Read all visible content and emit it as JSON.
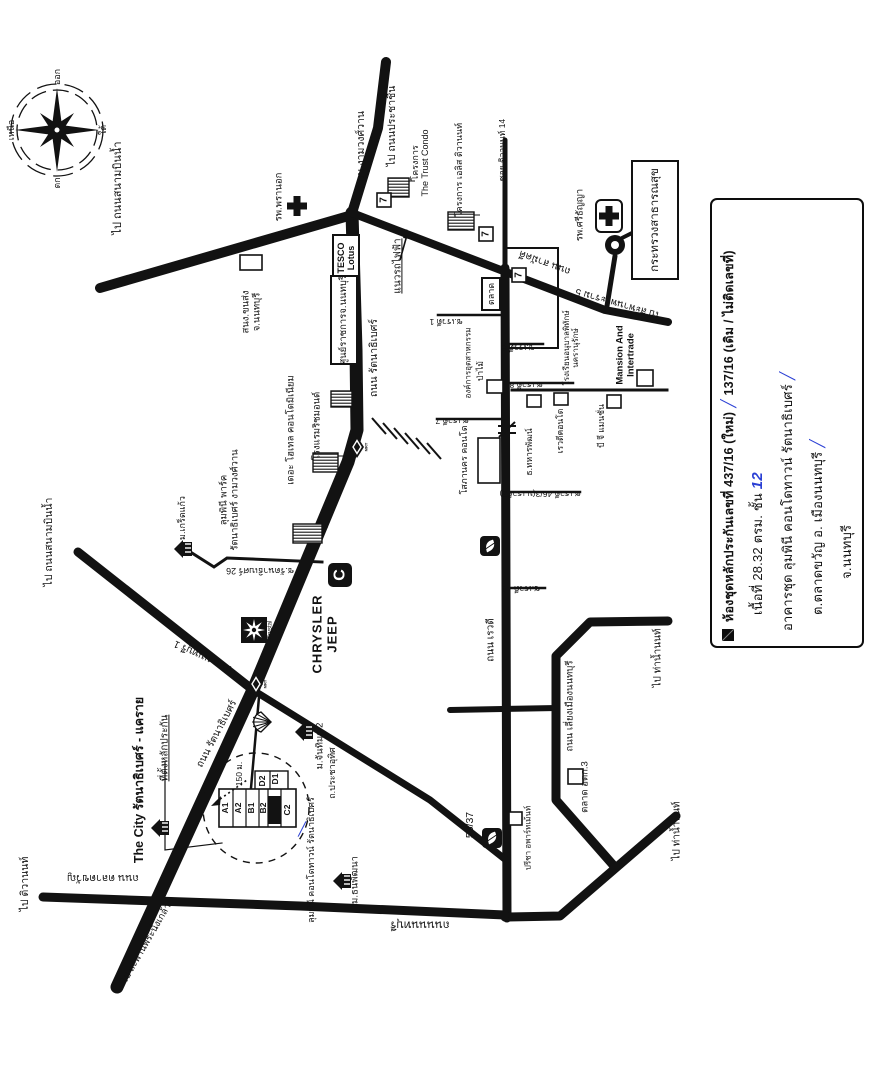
{
  "colors": {
    "ink": "#121212",
    "paper": "#ffffff",
    "blue": "#2a3fd4"
  },
  "compass": {
    "north": "เหนือ",
    "east": "ออก",
    "south": "ใต้",
    "west": "ตก",
    "cx": 57,
    "cy": 130
  },
  "legend": {
    "marker": "legend-black-square",
    "line1a": "ห้องชุดหลักประกันเลขที่ 437/16 (ใหม่)",
    "line1b": "137/16 (เดิม / ไม่ติดเลขที่)",
    "line2a": "เนื้อที่ 28.32 ตรม. ชั้น",
    "line2b": "12",
    "line3": "อาคารชุด ลุมพินี คอนโดทาวน์ รัตนาธิเบศร์",
    "line4": "ต.ตลาดขวัญ อ. เมืองนนทบุรี",
    "line5": "จ.นนทบุรี",
    "tick": "╱"
  },
  "map": {
    "labels": [
      {
        "t": "ไป ถนนสนามบินน้ำ",
        "x": 118,
        "y": 188,
        "r": -90,
        "s": 11
      },
      {
        "t": "รพ.พรานอก",
        "x": 280,
        "y": 197,
        "r": -90,
        "s": 9.5
      },
      {
        "t": "ถนน งามวงศ์วาน",
        "x": 362,
        "y": 150,
        "r": -90,
        "s": 10.5
      },
      {
        "t": "ไป ถนนประชาชื่น",
        "x": 393,
        "y": 126,
        "r": -90,
        "s": 10.5
      },
      {
        "t": "โครงการ\nThe Trust Condo",
        "x": 420,
        "y": 163,
        "r": -90,
        "s": 9
      },
      {
        "t": "โครงการ เอลิส ติวานนท์",
        "x": 459,
        "y": 170,
        "r": -90,
        "s": 9
      },
      {
        "t": "ซอย ติวานนท์ 14",
        "x": 503,
        "y": 150,
        "r": -90,
        "s": 8.5
      },
      {
        "t": "รพ.ศรีธัญญา",
        "x": 581,
        "y": 215,
        "r": -90,
        "s": 9.5
      },
      {
        "t": "กระทรวงสาธารณสุข",
        "x": 655,
        "y": 220,
        "r": -90,
        "s": 11.5,
        "box": [
          116,
          44
        ]
      },
      {
        "t": "ไป สะพานพระราม 5",
        "x": 618,
        "y": 303,
        "r": 196,
        "s": 10
      },
      {
        "t": "แนวรถไฟฟ้า",
        "x": 398,
        "y": 266,
        "r": -90,
        "s": 10,
        "u": 1
      },
      {
        "t": "TESCO\nLotus",
        "x": 346,
        "y": 258,
        "r": -90,
        "s": 9,
        "b": 1,
        "box": [
          44,
          24
        ]
      },
      {
        "t": "ศูนย์ราชการจ.นนทบุรี",
        "x": 344,
        "y": 320,
        "r": -90,
        "s": 9.5,
        "box": [
          86,
          24
        ]
      },
      {
        "t": "สนง.ขนส่ง\nจ.นนทบุรี",
        "x": 252,
        "y": 312,
        "r": -90,
        "s": 9.5
      },
      {
        "t": "ตลาด",
        "x": 491,
        "y": 294,
        "r": -90,
        "s": 9,
        "box": [
          30,
          16
        ]
      },
      {
        "t": "ถนน สามัคคี",
        "x": 545,
        "y": 262,
        "r": 200,
        "s": 10
      },
      {
        "t": "ถนน รัตนาธิเบศร์",
        "x": 375,
        "y": 358,
        "r": -90,
        "s": 10.5
      },
      {
        "t": "โรงแรมริชมอนด์",
        "x": 318,
        "y": 426,
        "r": -90,
        "s": 9.5
      },
      {
        "t": "เดอะ โฮเทล คอนโดมิเนียม",
        "x": 292,
        "y": 430,
        "r": -90,
        "s": 9.5
      },
      {
        "t": "ลุมพินี พาร์ค\nรัตนาธิเบศร์ งามวงศ์วาน",
        "x": 230,
        "y": 500,
        "r": -90,
        "s": 9.5
      },
      {
        "t": "ม.เกร็ดแก้ว",
        "x": 182,
        "y": 518,
        "r": -90,
        "s": 9
      },
      {
        "t": "ซ.รัตนาธิเบศร์ 26",
        "x": 260,
        "y": 571,
        "r": 180,
        "s": 9
      },
      {
        "t": "CHRYSLER\nJEEP",
        "x": 325,
        "y": 634,
        "r": -90,
        "s": 13,
        "b": 1,
        "ls": 1
      },
      {
        "t": "Crystal",
        "x": 271,
        "y": 630,
        "r": -90,
        "s": 6
      },
      {
        "t": "ถนน นนทบุรี 1",
        "x": 203,
        "y": 656,
        "r": 205,
        "s": 10
      },
      {
        "t": "ไป ถนนสนามบินน้ำ",
        "x": 50,
        "y": 542,
        "r": -90,
        "s": 10.5
      },
      {
        "t": "The City รัตนาธิเบศร์ - แคราย",
        "x": 139,
        "y": 780,
        "r": -90,
        "s": 12.5,
        "b": 1
      },
      {
        "t": "ที่ตั้งหลักประกัน",
        "x": 165,
        "y": 748,
        "r": -90,
        "s": 10,
        "u": 1
      },
      {
        "t": "ถนน รัตนาธิเบศร์",
        "x": 217,
        "y": 734,
        "r": -62,
        "s": 10
      },
      {
        "t": "150 ม.",
        "x": 240,
        "y": 774,
        "r": -90,
        "s": 8.5
      },
      {
        "t": "ม.จันทิมา 2",
        "x": 321,
        "y": 746,
        "r": -90,
        "s": 9.5
      },
      {
        "t": "ถ.ประชาอุทิศ",
        "x": 332,
        "y": 773,
        "r": -90,
        "s": 9
      },
      {
        "t": "ลุมพินี คอนโดทาวน์ รัตนาธิเบศร์",
        "x": 311,
        "y": 860,
        "r": -90,
        "s": 9
      },
      {
        "t": "╱",
        "x": 302,
        "y": 830,
        "r": 0,
        "s": 13,
        "c": "blue"
      },
      {
        "t": "ม.ธนพัฒนา",
        "x": 356,
        "y": 880,
        "r": -90,
        "s": 9.5
      },
      {
        "t": "ถนนนนทบุรี",
        "x": 420,
        "y": 924,
        "r": 180,
        "s": 11.5
      },
      {
        "t": "ไป ติวานนท์",
        "x": 26,
        "y": 884,
        "r": -90,
        "s": 10.5
      },
      {
        "t": "ถนน ตลาดขวัญ",
        "x": 103,
        "y": 877,
        "r": 180,
        "s": 10.5
      },
      {
        "t": "ไป สะพานพระนั่งเกล้า",
        "x": 147,
        "y": 944,
        "r": -60,
        "s": 9.5
      },
      {
        "t": "ถนน เรวดี",
        "x": 491,
        "y": 640,
        "r": -90,
        "s": 10
      },
      {
        "t": "ซ.เรวดี 1",
        "x": 446,
        "y": 321,
        "r": 180,
        "s": 8.5
      },
      {
        "t": "ซ.เรวดี 6",
        "x": 518,
        "y": 347,
        "r": 180,
        "s": 8.5
      },
      {
        "t": "ซ.เรวดี 8",
        "x": 526,
        "y": 384,
        "r": 180,
        "s": 8.5
      },
      {
        "t": "ซ.เรวดี 7",
        "x": 452,
        "y": 420,
        "r": 180,
        "s": 8.5
      },
      {
        "t": "ซ.เรวดี 46/3(ม.เรวดี3)",
        "x": 540,
        "y": 493,
        "r": 180,
        "s": 8.5
      },
      {
        "t": "ซ.เรวดี 48",
        "x": 521,
        "y": 588,
        "r": 180,
        "s": 8.5
      },
      {
        "t": "โสภานคร คอนโด",
        "x": 464,
        "y": 460,
        "r": -90,
        "s": 9
      },
      {
        "t": "องค์การอุตสาหกรรม",
        "x": 469,
        "y": 363,
        "r": -90,
        "s": 8
      },
      {
        "t": "ป่าไม้",
        "x": 481,
        "y": 371,
        "r": -90,
        "s": 8.5
      },
      {
        "t": "โรงเรียนอนุบาลพิทักษ์\nนครานุรักษ์",
        "x": 572,
        "y": 348,
        "r": -90,
        "s": 8
      },
      {
        "t": "Mansion And\nIntertrade",
        "x": 626,
        "y": 355,
        "r": -90,
        "s": 9.5,
        "b": 1
      },
      {
        "t": "บี จี แมนชั่น",
        "x": 602,
        "y": 426,
        "r": -90,
        "s": 8.5
      },
      {
        "t": "เรวดีคอนโด",
        "x": 561,
        "y": 431,
        "r": -90,
        "s": 8.5
      },
      {
        "t": "ธ.ทหารพัฒน์",
        "x": 530,
        "y": 452,
        "r": -90,
        "s": 8.5
      },
      {
        "t": "ถนน เลี่ยงเมืองนนทบุรี",
        "x": 571,
        "y": 706,
        "r": -90,
        "s": 9.5
      },
      {
        "t": "ไป ท่าน้ำนนท์",
        "x": 658,
        "y": 658,
        "r": -90,
        "s": 10
      },
      {
        "t": "ไป ท่าน้ำนนท์",
        "x": 677,
        "y": 831,
        "r": -90,
        "s": 10
      },
      {
        "t": "ตลาด อตก.3",
        "x": 586,
        "y": 787,
        "r": -90,
        "s": 9.5
      },
      {
        "t": "55/37",
        "x": 471,
        "y": 825,
        "r": -90,
        "s": 10.5
      },
      {
        "t": "ปรีชา อพาร์ทเม้นท์",
        "x": 529,
        "y": 838,
        "r": -90,
        "s": 8
      },
      {
        "t": "ออก",
        "x": 57,
        "y": 77,
        "r": -90,
        "s": 9
      },
      {
        "t": "เหนือ",
        "x": 11,
        "y": 130,
        "r": -90,
        "s": 9
      },
      {
        "t": "ใต้",
        "x": 103,
        "y": 130,
        "r": -90,
        "s": 9
      },
      {
        "t": "ตก",
        "x": 57,
        "y": 183,
        "r": -90,
        "s": 9
      }
    ],
    "roads": [
      {
        "w": 13,
        "pts": [
          [
            352,
            213
          ],
          [
            356,
            350
          ],
          [
            357,
            430
          ],
          [
            348,
            462
          ],
          [
            253,
            690
          ],
          [
            117,
            987
          ]
        ]
      },
      {
        "w": 10,
        "pts": [
          [
            352,
            215
          ],
          [
            100,
            288
          ]
        ]
      },
      {
        "w": 10,
        "pts": [
          [
            352,
            213
          ],
          [
            378,
            128
          ],
          [
            386,
            62
          ]
        ]
      },
      {
        "w": 8,
        "pts": [
          [
            352,
            213
          ],
          [
            605,
            310
          ],
          [
            668,
            322
          ]
        ]
      },
      {
        "w": 5,
        "pts": [
          [
            505,
            140
          ],
          [
            505,
            268
          ]
        ]
      },
      {
        "w": 9,
        "pts": [
          [
            505,
            268
          ],
          [
            507,
            918
          ]
        ]
      },
      {
        "w": 6,
        "pts": [
          [
            450,
            710
          ],
          [
            557,
            708
          ]
        ]
      },
      {
        "w": 9,
        "pts": [
          [
            668,
            621
          ],
          [
            590,
            622
          ],
          [
            556,
            656
          ],
          [
            556,
            800
          ],
          [
            614,
            866
          ]
        ]
      },
      {
        "w": 9,
        "pts": [
          [
            676,
            816
          ],
          [
            560,
            916
          ],
          [
            505,
            917
          ]
        ]
      },
      {
        "w": 9,
        "pts": [
          [
            43,
            897
          ],
          [
            300,
            906
          ],
          [
            505,
            915
          ]
        ]
      },
      {
        "w": 9,
        "pts": [
          [
            253,
            690
          ],
          [
            78,
            552
          ]
        ]
      },
      {
        "w": 7,
        "pts": [
          [
            253,
            690
          ],
          [
            430,
            800
          ],
          [
            506,
            860
          ]
        ]
      },
      {
        "w": 5,
        "pts": [
          [
            615,
            256
          ],
          [
            607,
            306
          ]
        ]
      },
      {
        "w": 4,
        "pts": [
          [
            622,
            238
          ],
          [
            638,
            230
          ]
        ]
      }
    ],
    "thin_roads": [
      {
        "w": 3,
        "pts": [
          [
            192,
            553
          ],
          [
            214,
            567
          ],
          [
            227,
            558
          ],
          [
            322,
            562
          ]
        ]
      },
      {
        "w": 2.5,
        "pts": [
          [
            259,
            697
          ],
          [
            251,
            788
          ]
        ]
      },
      {
        "w": 2.5,
        "pts": [
          [
            438,
            315
          ],
          [
            503,
            315
          ]
        ]
      },
      {
        "w": 2.5,
        "pts": [
          [
            507,
            344
          ],
          [
            543,
            344
          ]
        ]
      },
      {
        "w": 2.5,
        "pts": [
          [
            507,
            383
          ],
          [
            573,
            383
          ]
        ]
      },
      {
        "w": 2.5,
        "pts": [
          [
            437,
            419
          ],
          [
            503,
            419
          ]
        ]
      },
      {
        "w": 2.5,
        "pts": [
          [
            508,
            492
          ],
          [
            580,
            492
          ]
        ]
      },
      {
        "w": 2.5,
        "pts": [
          [
            508,
            588
          ],
          [
            545,
            588
          ]
        ]
      },
      {
        "w": 3,
        "pts": [
          [
            512,
            390
          ],
          [
            667,
            390
          ]
        ]
      },
      {
        "w": 1.2,
        "pts": [
          [
            165,
            762
          ],
          [
            165,
            850
          ],
          [
            222,
            843
          ]
        ]
      }
    ],
    "outline_rects": [
      [
        506,
        248,
        52,
        100
      ]
    ],
    "squares": [
      [
        240,
        255,
        22,
        15
      ],
      [
        487,
        380,
        16,
        13
      ],
      [
        527,
        395,
        14,
        12
      ],
      [
        554,
        393,
        14,
        12
      ],
      [
        478,
        438,
        22,
        45
      ],
      [
        637,
        370,
        16,
        16
      ],
      [
        607,
        395,
        14,
        13
      ],
      [
        568,
        769,
        15,
        15
      ],
      [
        509,
        812,
        13,
        13
      ]
    ],
    "hatched_buildings": [
      [
        388,
        178,
        21,
        19
      ],
      [
        448,
        212,
        26,
        18
      ],
      [
        331,
        391,
        21,
        16
      ],
      [
        313,
        453,
        25,
        19
      ],
      [
        293,
        524,
        29,
        19
      ]
    ],
    "rail_hatch": [
      [
        372,
        418,
        386,
        434
      ],
      [
        383,
        423,
        397,
        439
      ],
      [
        394,
        428,
        408,
        444
      ],
      [
        405,
        433,
        419,
        449
      ],
      [
        416,
        438,
        430,
        454
      ],
      [
        427,
        443,
        441,
        459
      ]
    ],
    "icons": [
      {
        "type": "cross",
        "x": 297,
        "y": 206
      },
      {
        "type": "cross-box",
        "x": 609,
        "y": 216
      },
      {
        "type": "seven",
        "x": 384,
        "y": 200,
        "glyph": "7"
      },
      {
        "type": "seven",
        "x": 486,
        "y": 234,
        "glyph": "7"
      },
      {
        "type": "seven",
        "x": 519,
        "y": 275,
        "glyph": "7"
      },
      {
        "type": "leaf",
        "x": 490,
        "y": 546
      },
      {
        "type": "leaf",
        "x": 492,
        "y": 838
      },
      {
        "type": "shell",
        "x": 262,
        "y": 722
      },
      {
        "type": "mrt",
        "x": 357,
        "y": 447,
        "glyph": "MRT"
      },
      {
        "type": "mrt",
        "x": 256,
        "y": 684,
        "glyph": "MRT"
      },
      {
        "type": "village",
        "x": 185,
        "y": 549
      },
      {
        "type": "village",
        "x": 162,
        "y": 828
      },
      {
        "type": "village",
        "x": 306,
        "y": 732
      },
      {
        "type": "village",
        "x": 344,
        "y": 881
      },
      {
        "type": "clogo",
        "x": 340,
        "y": 575,
        "glyph": "C"
      },
      {
        "type": "crystal",
        "x": 254,
        "y": 630
      },
      {
        "type": "roundabout",
        "x": 615,
        "y": 245
      },
      {
        "type": "railcross",
        "x": 507,
        "y": 430
      }
    ],
    "blocks": {
      "main": [
        219,
        789,
        77,
        38
      ],
      "dividers": [
        233,
        246,
        259,
        268,
        281
      ],
      "black": [
        268,
        796,
        13,
        28
      ],
      "dwing": [
        255,
        771,
        33,
        20
      ],
      "ddiv": 270,
      "cells": [
        {
          "t": "A1",
          "x": 226,
          "y": 808
        },
        {
          "t": "A2",
          "x": 239,
          "y": 808
        },
        {
          "t": "B1",
          "x": 252,
          "y": 808
        },
        {
          "t": "B2",
          "x": 264,
          "y": 808
        },
        {
          "t": "C2",
          "x": 288,
          "y": 810
        },
        {
          "t": "D2",
          "x": 263,
          "y": 781
        },
        {
          "t": "D1",
          "x": 276,
          "y": 779
        }
      ]
    },
    "dashed_circle": {
      "cx": 256,
      "cy": 808,
      "rx": 53,
      "ry": 55
    },
    "arrows": {
      "rail_arrow": {
        "line": [
          400,
          260,
          407,
          235
        ],
        "head": [
          407,
          232
        ]
      },
      "dist_arrow": {
        "dotted": [
          216,
          802,
          247,
          780
        ],
        "head": [
          213,
          804
        ]
      }
    }
  }
}
